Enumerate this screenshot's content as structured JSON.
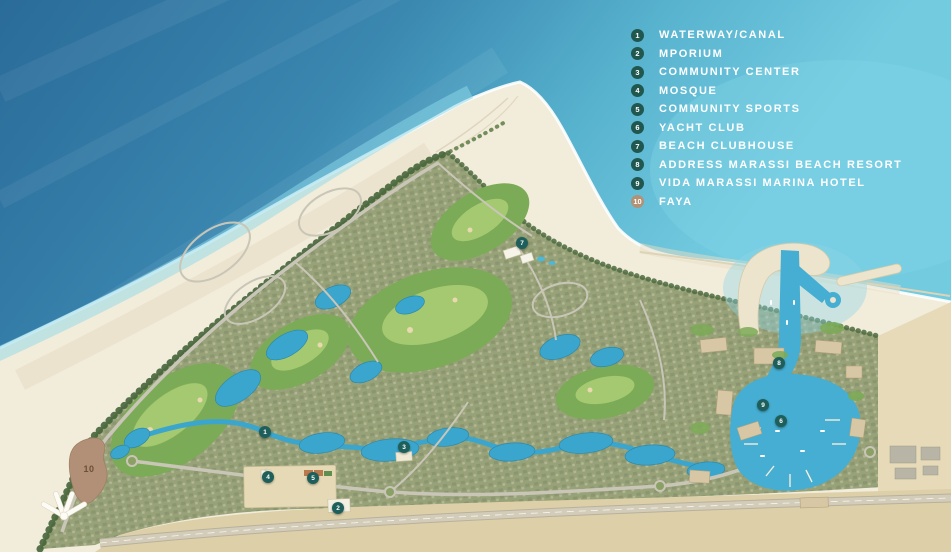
{
  "legend": {
    "marker_color": "#20584f",
    "faya_marker_color": "#b29175",
    "text_color": "#ffffff",
    "items": [
      {
        "number": "1",
        "label": "WATERWAY/CANAL"
      },
      {
        "number": "2",
        "label": "MPORIUM"
      },
      {
        "number": "3",
        "label": "COMMUNITY CENTER"
      },
      {
        "number": "4",
        "label": "MOSQUE"
      },
      {
        "number": "5",
        "label": "COMMUNITY SPORTS"
      },
      {
        "number": "6",
        "label": "YACHT CLUB"
      },
      {
        "number": "7",
        "label": "BEACH CLUBHOUSE"
      },
      {
        "number": "8",
        "label": "ADDRESS MARASSI BEACH RESORT"
      },
      {
        "number": "9",
        "label": "VIDA MARASSI MARINA HOTEL"
      },
      {
        "number": "10",
        "label": "FAYA"
      }
    ]
  },
  "map": {
    "type": "resort-masterplan-aerial",
    "colors": {
      "sea_deep": "#2a6b99",
      "sea_shallow": "#73cbe0",
      "beach_sand": "#f2ecdb",
      "development": "#98a278",
      "golf_green": "#7cab57",
      "lagoon_blue": "#3ba6cd",
      "marina_blue": "#45aed2",
      "desert": "#ddd0a9",
      "road": "#c9c6b7",
      "faya_zone": "#b29077",
      "map_marker": "#1e5f5b"
    }
  }
}
